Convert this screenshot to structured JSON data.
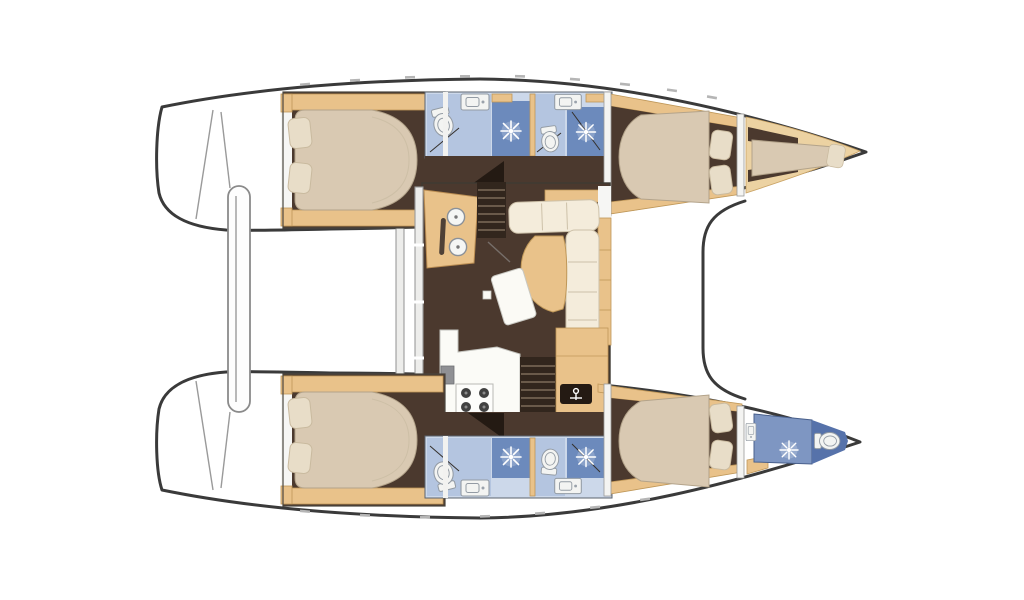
{
  "diagram": {
    "type": "catamaran-floor-plan",
    "view": "top-down interior layout, bows pointing right",
    "hulls": 2
  },
  "inventory": {
    "double_berths": 4,
    "bow_berths": 1,
    "bathrooms": 5,
    "shower_sprays": 5,
    "toilets": 5,
    "bathroom_sinks": 5,
    "galley_sink_bowls": 2,
    "stove_burners": 4,
    "companionway_stairs": 2,
    "sofa_cushions": 7,
    "pillows": 9,
    "cockpit_bench": 1,
    "transom_steps": 2
  },
  "legend": {
    "dark_brown": "cabin sole / saloon floor",
    "tan": "woodwork, trim and furniture",
    "beige": "berth mattresses",
    "cream": "saloon sofa cushions",
    "light_blue": "bathroom floor",
    "mid_blue": "shower area",
    "white": "deck and fixtures"
  },
  "colors": {
    "outline": "#3a3a3a",
    "deck": "#ffffff",
    "floor": "#4b392e",
    "wood": "#e9c28a",
    "wood_line": "#bf9758",
    "wood_light": "#ecd2a2",
    "bed": "#d9c9b2",
    "bed_line": "#b3a38a",
    "pillow": "#e8ddc8",
    "pillow_line": "#c9ba9f",
    "cushion": "#f4ecdb",
    "cushion_line": "#cdc1a9",
    "bath_base": "#ccd8ea",
    "bath_floor": "#b4c5e0",
    "shower_blue": "#6c8abc",
    "bow_blue": "#7e96c2",
    "bow_blue_dark": "#5672aa",
    "fixture": "#f3f4f2",
    "fixture_line": "#939ba4",
    "counter": "#fbfbf7",
    "counter_line": "#c2c2bd",
    "inner_line": "#9a9a9a",
    "burner": "#414141",
    "stair_dark": "#32261d",
    "tread": "#7d6c5a",
    "door_dark": "#241a13",
    "wall_gray": "#ededeb"
  }
}
